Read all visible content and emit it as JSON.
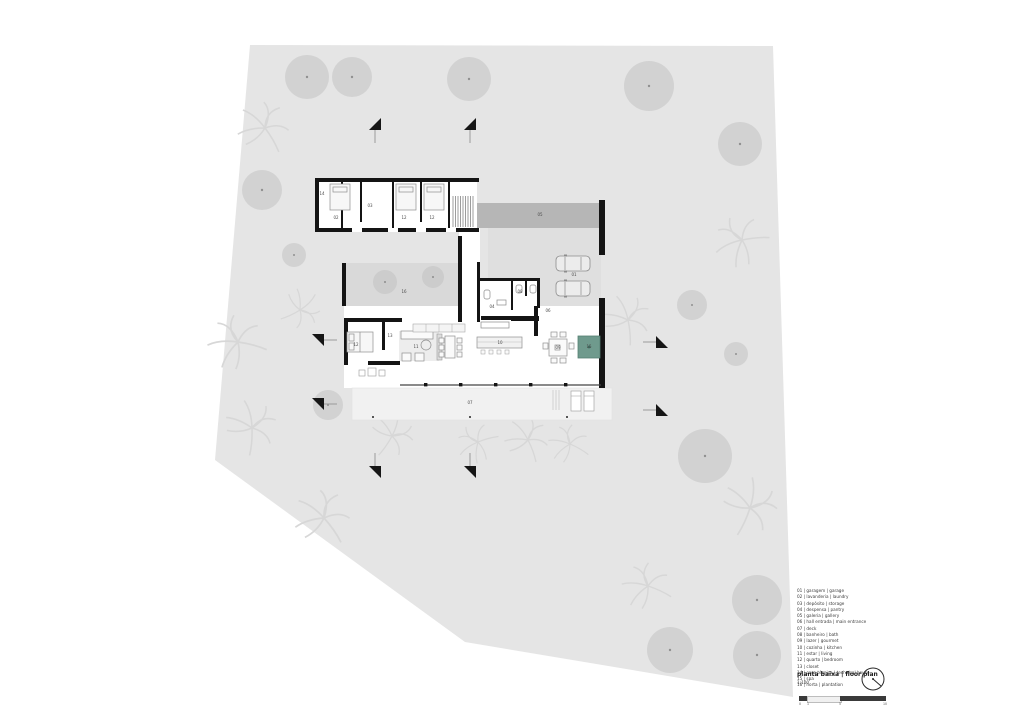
{
  "document": {
    "type": "architectural floor plan drawing",
    "title": "planta baixa  | floor plan",
    "scale": "1:100"
  },
  "legend": {
    "items": [
      "01 | garagem | garage",
      "02 | lavanderia | laundry",
      "03 | depósito | storage",
      "04 | despensa | pantry",
      "05 | galeria | gallery",
      "06 | hall entrada | main entrance",
      "07 | deck",
      "08 | banheiro | bath",
      "09 | lazer | gourmet",
      "10 | cozinha | kitchen",
      "11 | estar | living",
      "12 | quarto | bedroom",
      "13 | closet",
      "14 | casa técnica | technical house",
      "15 | spa",
      "16 | horta | plantation"
    ]
  },
  "titleblock": {
    "title": "planta baixa  | floor plan",
    "scale": "1:100"
  },
  "scalebar": {
    "ticks": [
      "0",
      "1",
      "5",
      "10"
    ]
  },
  "colors": {
    "site": "#e5e5e5",
    "tree": "#d2d2d2",
    "tree_dot": "#909090",
    "pergola": "#b6b6b6",
    "driveway": "#dfdfdf",
    "courtyard": "#d9d9d9",
    "deck": "#f1f1f1",
    "wall": "#141414",
    "spa": "#6f9a8d"
  },
  "plan": {
    "labels": [
      {
        "text": "14"
      },
      {
        "text": "02"
      },
      {
        "text": "03"
      },
      {
        "text": "12"
      },
      {
        "text": "12"
      },
      {
        "text": "05"
      },
      {
        "text": "16"
      },
      {
        "text": "01"
      },
      {
        "text": "04"
      },
      {
        "text": "08"
      },
      {
        "text": "06"
      },
      {
        "text": "13"
      },
      {
        "text": "12"
      },
      {
        "text": "11"
      },
      {
        "text": "10"
      },
      {
        "text": "09"
      },
      {
        "text": "15"
      },
      {
        "text": "07"
      }
    ]
  }
}
